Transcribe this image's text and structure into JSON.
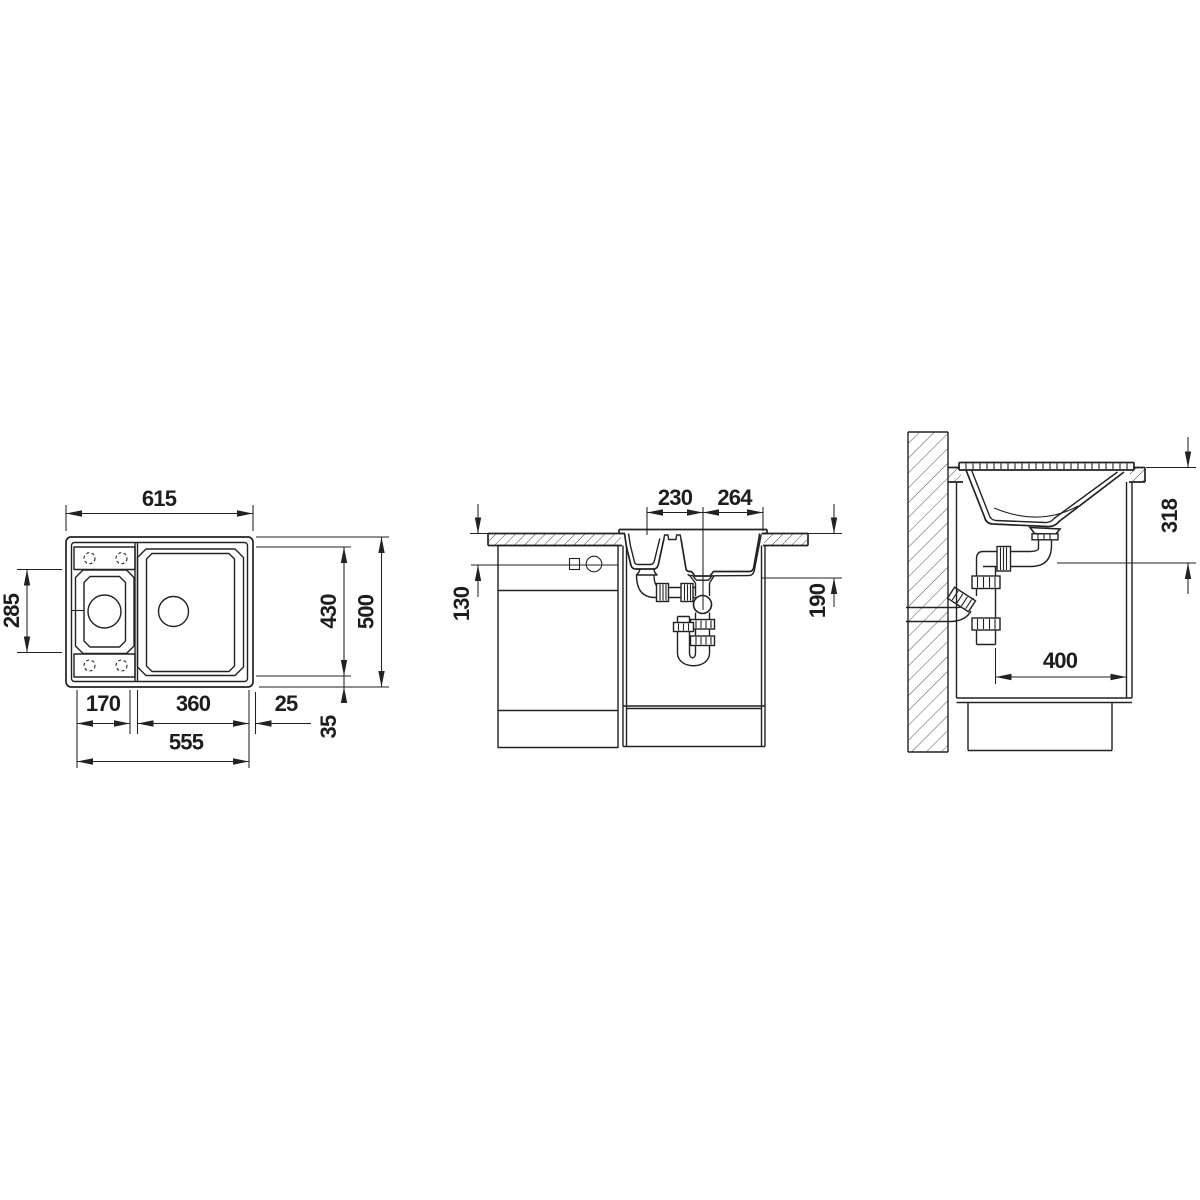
{
  "colors": {
    "line_color": "#222222",
    "background": "#ffffff"
  },
  "views": {
    "top": {
      "overall_width": "615",
      "left_bowl_length": "285",
      "bowl_zone_length": "430",
      "overall_length": "500",
      "rear_margin": "35",
      "left_bowl_width": "170",
      "main_bowl_width": "360",
      "side_margin": "25",
      "cutout_width": "555"
    },
    "front": {
      "drain_spacing": "230",
      "drain_to_edge": "264",
      "connection_height": "130",
      "bowl_depth": "190"
    },
    "side": {
      "drain_outlet_height": "318",
      "base_clearance": "400"
    }
  }
}
